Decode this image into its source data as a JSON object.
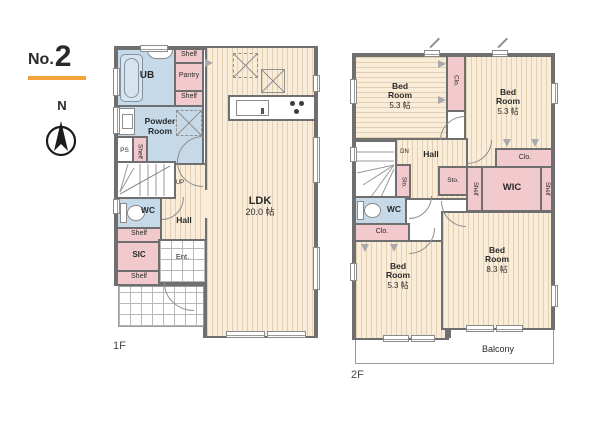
{
  "colors": {
    "accent_orange": "#f2a43c",
    "wall_gray": "#6f6f6f",
    "room_cream": "#f9ecd8",
    "wet_area_blue": "#c6d9e8",
    "storage_pink": "#f2c9cc"
  },
  "header": {
    "no_label": "No.",
    "no_value": "2",
    "north": "N"
  },
  "labels": {
    "shelf": "Shelf",
    "pantry": "Pantry",
    "ub": "UB",
    "powder_room": "Powder Room",
    "ps": "PS",
    "up": "UP",
    "dn": "DN",
    "wc": "WC",
    "hall": "Hall",
    "sic": "SIC",
    "ent": "Ent.",
    "clo": "Clo.",
    "sto": "Sto.",
    "wic": "WIC",
    "bed_room": "Bed Room"
  },
  "floor1": {
    "label": "1F",
    "ldk_name": "LDK",
    "ldk_size": "20.0 帖"
  },
  "floor2": {
    "label": "2F",
    "balcony": "Balcony",
    "bedroom_sizes": {
      "top_left": "5.3 帖",
      "top_right": "5.3 帖",
      "bottom_left": "5.3 帖",
      "bottom_right": "8.3 帖"
    }
  }
}
